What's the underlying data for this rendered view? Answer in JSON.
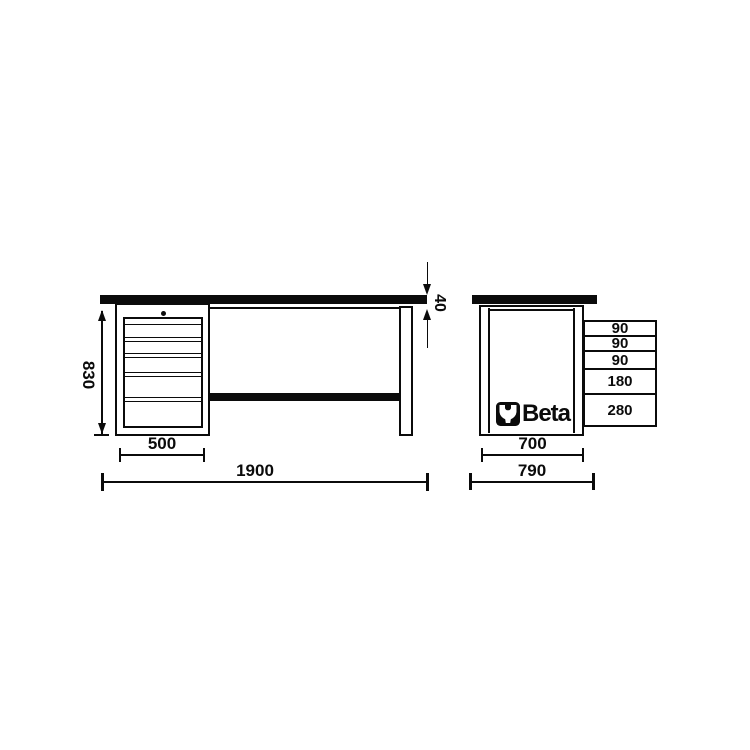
{
  "brand": {
    "name": "Beta",
    "icon": "beta-wrench-icon"
  },
  "colors": {
    "ink": "#0b0b0b",
    "background": "#ffffff"
  },
  "front_view": {
    "height": "830",
    "cabinet_width": "500",
    "total_width": "1900",
    "top_thickness": "40"
  },
  "side_view": {
    "drawers": [
      "90",
      "90",
      "90",
      "180",
      "280"
    ],
    "inner_width": "700",
    "total_depth": "790"
  }
}
